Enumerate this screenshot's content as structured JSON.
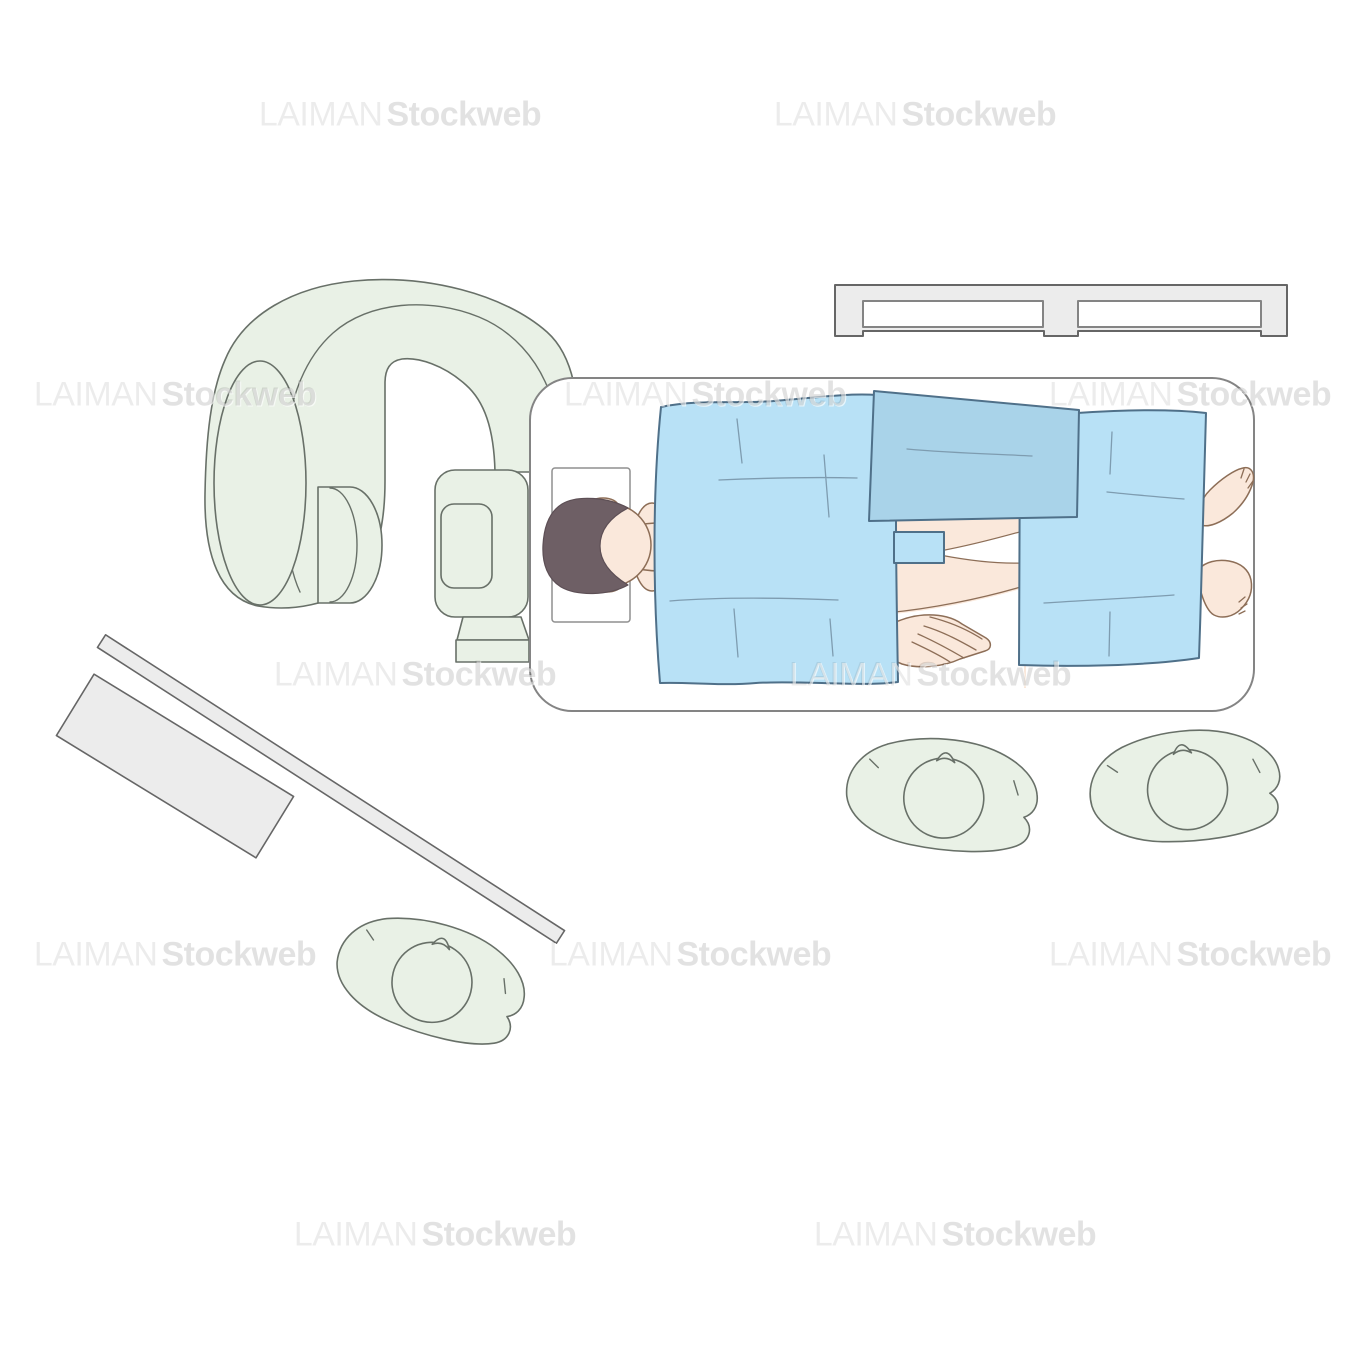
{
  "artwork": {
    "type": "medical stock illustration, top view",
    "background": "#ffffff"
  },
  "watermark": {
    "part1": "LAIMAN",
    "part2": "Stockweb"
  },
  "palette": {
    "machine_green": "#e9f1e6",
    "machine_outline": "#687068",
    "equipment_gray": "#ececec",
    "equipment_outline": "#666666",
    "table_outline": "#848484",
    "drape_blue": "#b8e1f6",
    "drape_blue_dark": "#a9d3e9",
    "drape_outline": "#4f7089",
    "drape_crease": "#7e9cb0",
    "skin": "#fae8db",
    "skin_outline": "#8d6e57",
    "hair": "#6e5f65",
    "hair_outline": "#5d4f55",
    "wm_primary": "rgba(0,0,0,0.075)",
    "wm_secondary": "rgba(0,0,0,0.115)"
  },
  "scene": {
    "machine": "C-arm imaging system at head end of table",
    "table": "operating table, patient supine, head at left",
    "patient": "dark-haired patient under light blue drapes, hip exposed, hand on thigh, feet out at right",
    "drapes": [
      "upper body drape",
      "lower body drape",
      "folded dark drape across chest",
      "small sterile towel at hip"
    ],
    "staff": [
      "staff member below table center",
      "staff member below table right",
      "staff member bottom left"
    ],
    "equipment": [
      "equipment rail top right",
      "tilted instrument table bottom left",
      "long rail bar bottom left"
    ]
  }
}
